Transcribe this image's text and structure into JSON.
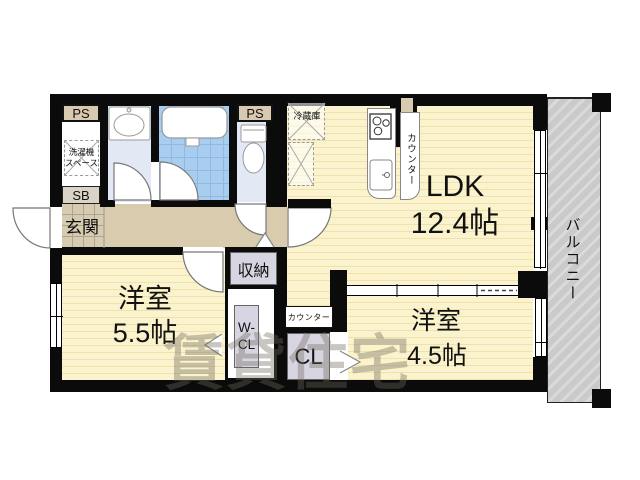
{
  "rooms": {
    "ldk": {
      "label": "LDK",
      "size": "12.4帖"
    },
    "western1": {
      "label": "洋室",
      "size": "5.5帖"
    },
    "western2": {
      "label": "洋室",
      "size": "4.5帖"
    },
    "balcony": {
      "label": "バルコニー"
    },
    "entrance": {
      "label": "玄関"
    }
  },
  "features": {
    "ps_left": "PS",
    "ps_right": "PS",
    "shoe_box": "SB",
    "washer_space_line1": "洗濯機",
    "washer_space_line2": "スペース",
    "fridge": "冷蔵庫",
    "kitchen_counter": "カウンター",
    "storage": "収納",
    "walk_in_closet_line1": "W-",
    "walk_in_closet_line2": "CL",
    "counter2": "カウンター",
    "closet": "CL"
  },
  "watermark": "賃貸住宅",
  "colors": {
    "wall": "#0b0b0b",
    "room_floor": "#FAF3CE",
    "room_stripe": "#EFE2AB",
    "hall_floor": "#D8CBAE",
    "wet_floor": "#E2E9F5",
    "bath_tile": "#A9CDEF",
    "bath_grid": "#8FB9E2",
    "balcony_fill": "#CACACA",
    "balcony_stripe": "#DADADA",
    "label_box": "#D8D5E2",
    "ps_box": "#D8C9B1",
    "sb_box": "#DBD3C5",
    "entrance_tile": "#D7CCB2",
    "entrance_grid": "#AFA48D"
  }
}
